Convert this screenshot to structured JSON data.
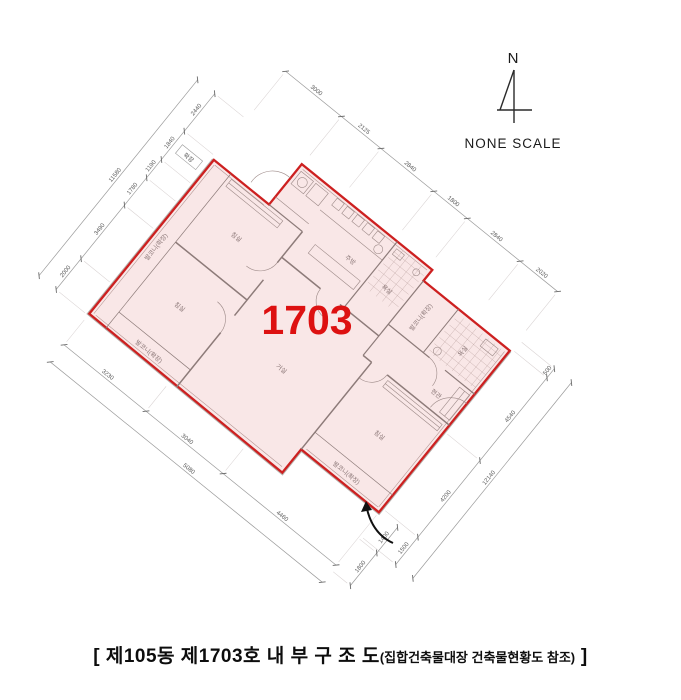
{
  "north": {
    "label": "N",
    "scale_label": "NONE SCALE"
  },
  "unit": {
    "number": "1703"
  },
  "caption": {
    "open": "[ ",
    "title": "제105동 제1703호 내 부 구 조 도",
    "note": "(집합건축물대장 건축물현황도 참조)",
    "close": " ]"
  },
  "colors": {
    "outline": "#cd2020",
    "fill": "#f9e7e7",
    "unit_label": "#dd1111",
    "walls": "#8d7b79"
  },
  "rooms": {
    "bed1": "침실",
    "bed2": "침실",
    "bed3": "침실",
    "living": "거실",
    "kitchen": "주방",
    "entry": "현관",
    "bath1": "욕실",
    "bath2": "욕실",
    "balcony_left": "발코니(확장)",
    "balcony_bottom": "발코니(확장)",
    "balcony_right": "발코니(확장)",
    "balcony_top": "발코니(확장)",
    "ext_box": "확장"
  },
  "dims": {
    "top": [
      "3000",
      "2125",
      "2840",
      "1800",
      "2840",
      "2020"
    ],
    "left": [
      "2440",
      "1840",
      "1190",
      "1780",
      "3490",
      "2000"
    ],
    "left_total": "11580",
    "right": [
      "500",
      "4540",
      "4200",
      "1500"
    ],
    "right_total": "12140",
    "bottom": [
      "3230",
      "3040",
      "4460"
    ],
    "bottom_outer": "5080",
    "entry": [
      "1400",
      "1800"
    ]
  }
}
